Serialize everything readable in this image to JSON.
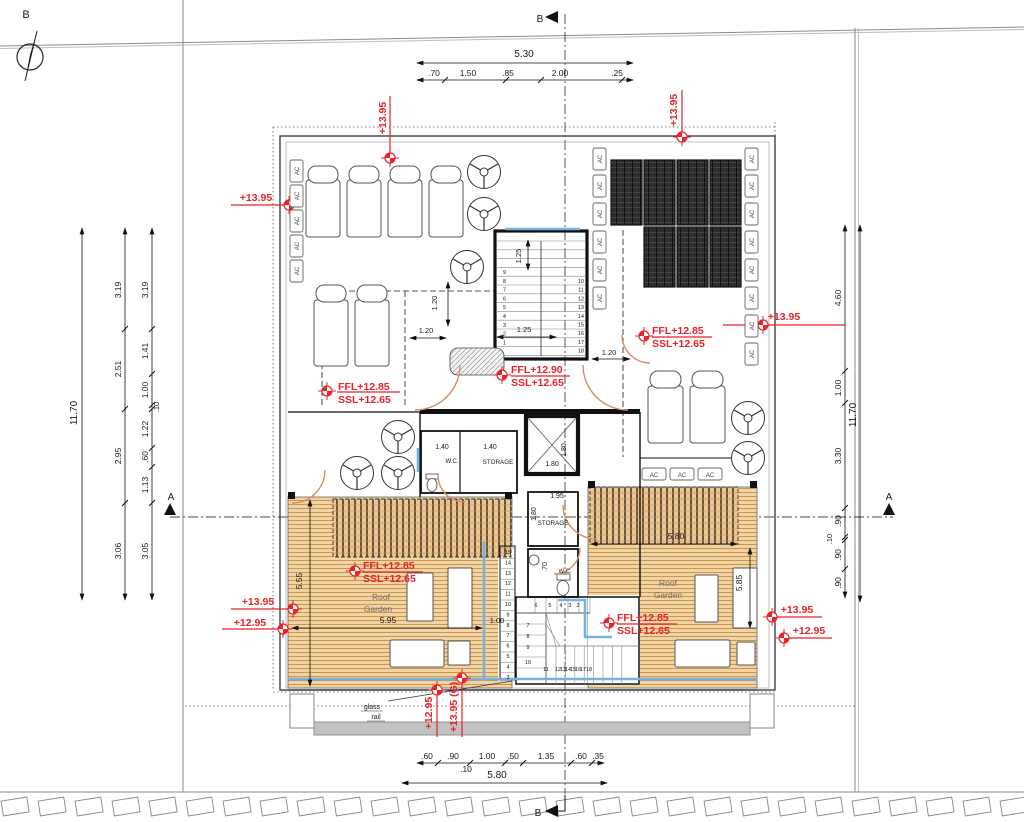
{
  "title": "Penthouse roof floor plan",
  "colors": {
    "annotation_red": "#e8232a",
    "deck_fill": "#f2d3a4",
    "deck_line": "#c9954f",
    "glass_blue": "#74b2e2",
    "door_arc": "#d98c5f",
    "solar_dark": "#2d2d2d",
    "wall_black": "#111111"
  },
  "labels": {
    "north_b": "B",
    "sec_a": "A",
    "sec_b": "B",
    "d530": "5.30",
    "d70": ".70",
    "d150": "1.50",
    "d85": ".85",
    "d200": "2.00",
    "d25": ".25",
    "d1170": "11.70",
    "d319": "3.19",
    "d251": "2.51",
    "d295": "2.95",
    "d306": "3.06",
    "d141": "1.41",
    "d100": "1.00",
    "d10": ".10",
    "d122": "1.22",
    "d60": ".60",
    "d113": "1.13",
    "d305": "3.05",
    "d460": "4.60",
    "d330": "3.30",
    "d90": ".90",
    "d580": "5.80",
    "d50": ".50",
    "d135": "1.35",
    "d35": ".35",
    "d125": "1.25",
    "d120": "1.20",
    "d140": "1.40",
    "d180": "1.80",
    "d195": "1.95",
    "d555": "5.55",
    "d595": "5.95",
    "d585": "5.85",
    "lvl1395": "+13.95",
    "lvl1295": "+12.95",
    "lvl1395g": "+13.95 (G)",
    "ffl1285": "FFL+12.85",
    "ffl1290": "FFL+12.90",
    "ssl1265": "SSL+12.65",
    "wc": "W.C.",
    "storage": "STORAGE",
    "roof": "Roof",
    "garden": "Garden",
    "glass": "glass",
    "rail": "rail",
    "ac": "AC"
  },
  "stairs": {
    "upper_left": [
      "9",
      "8",
      "7",
      "6",
      "5",
      "4",
      "3",
      "2",
      "1"
    ],
    "upper_right": [
      "10",
      "11",
      "12",
      "13",
      "14",
      "15",
      "16",
      "17",
      "18"
    ],
    "side": [
      "15",
      "14",
      "13",
      "12",
      "11",
      "10",
      "9",
      "8",
      "7",
      "6",
      "5",
      "4",
      "3"
    ],
    "lower_top": [
      "6",
      "5",
      "4",
      "3",
      "2"
    ],
    "lower_left": [
      "7",
      "8",
      "9",
      "10"
    ],
    "lower_mid": "11",
    "lower_bottom": [
      "12",
      "13",
      "14",
      "15",
      "16",
      "17"
    ],
    "lower_last": "18"
  }
}
